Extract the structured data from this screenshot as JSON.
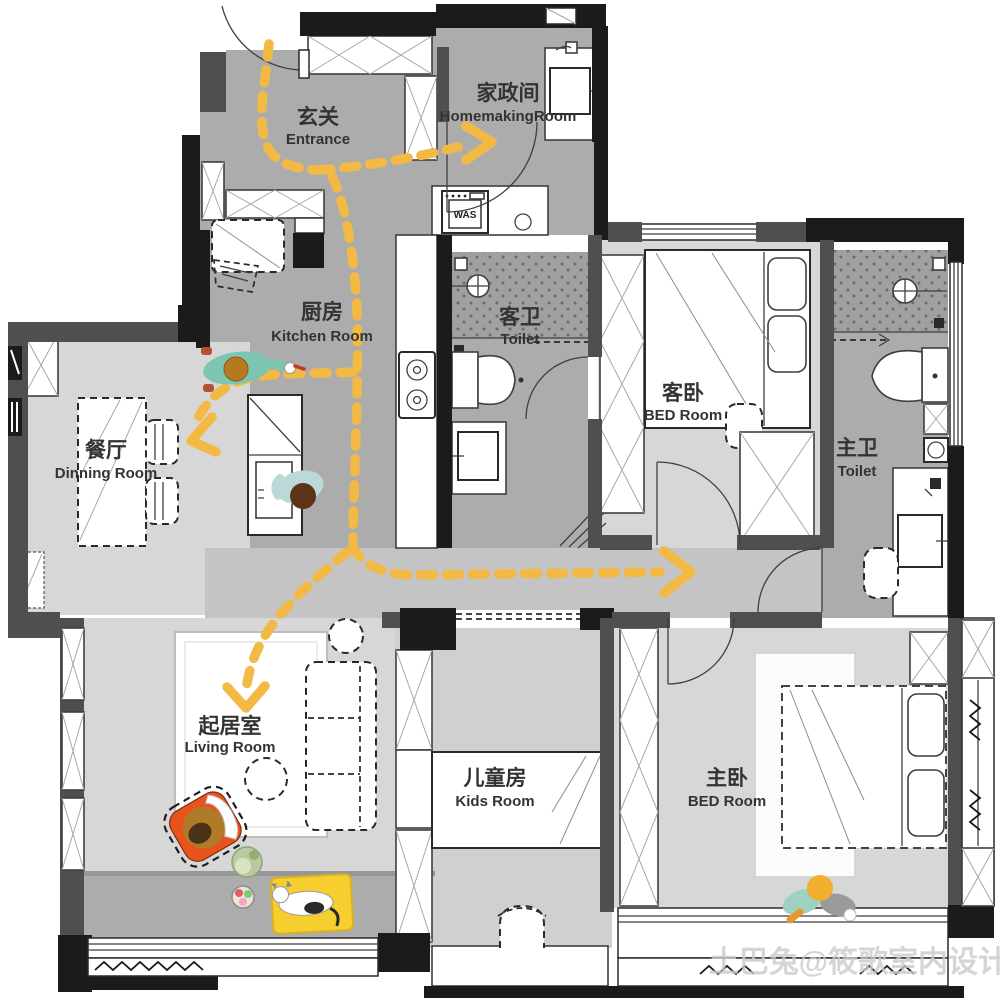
{
  "title": "apartment-floor-plan",
  "colors": {
    "accent_path": "#F2BA45",
    "wall": "#1B1B1B",
    "floor_dark": "#ACACAC",
    "floor_light": "#D7D7D7"
  },
  "rooms": [
    {
      "id": "entrance",
      "zh": "玄关",
      "en": "Entrance"
    },
    {
      "id": "homemaking",
      "zh": "家政间",
      "en": "HomemakingRoom"
    },
    {
      "id": "kitchen",
      "zh": "厨房",
      "en": "Kitchen Room"
    },
    {
      "id": "guest_toilet",
      "zh": "客卫",
      "en": "Toilet"
    },
    {
      "id": "guest_bedroom",
      "zh": "客卧",
      "en": "BED Room"
    },
    {
      "id": "master_toilet",
      "zh": "主卫",
      "en": "Toilet"
    },
    {
      "id": "dining",
      "zh": "餐厅",
      "en": "Dinning Room"
    },
    {
      "id": "living",
      "zh": "起居室",
      "en": "Living Room"
    },
    {
      "id": "kids",
      "zh": "儿童房",
      "en": "Kids Room"
    },
    {
      "id": "master_bedroom",
      "zh": "主卧",
      "en": "BED Room"
    }
  ],
  "appliances": {
    "washer_label": "WAS"
  },
  "watermark": "土巴兔@筱歌室内设计"
}
